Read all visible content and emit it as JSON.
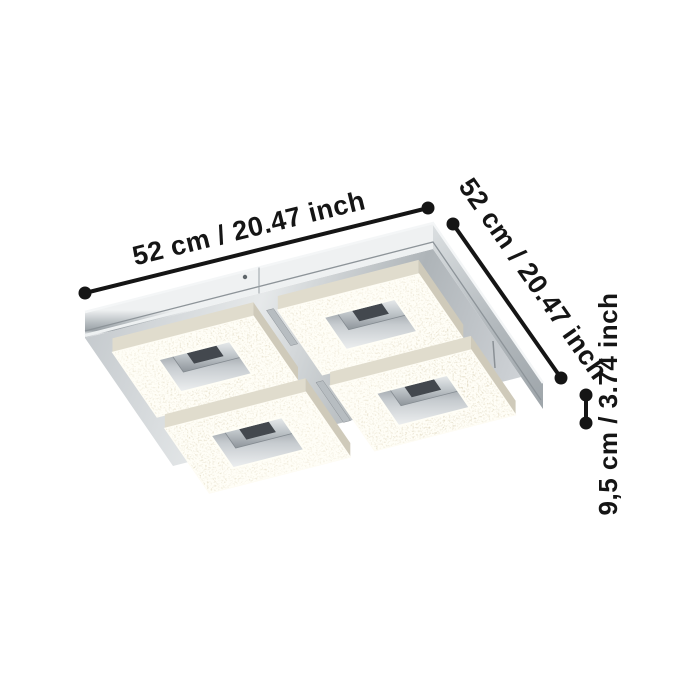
{
  "diagram": {
    "subject": "square-led-ceiling-light-with-four-crystal-panels",
    "dimensions": {
      "width_label": "52 cm / 20.47 inch",
      "depth_label": "52 cm / 20.47 inch",
      "height_label": "9,5 cm / 3.74 inch"
    },
    "colors": {
      "annotation": "#151515",
      "background": "#ffffff",
      "chrome": "#c2c8cb",
      "crystal": "#e9e3d1"
    }
  }
}
